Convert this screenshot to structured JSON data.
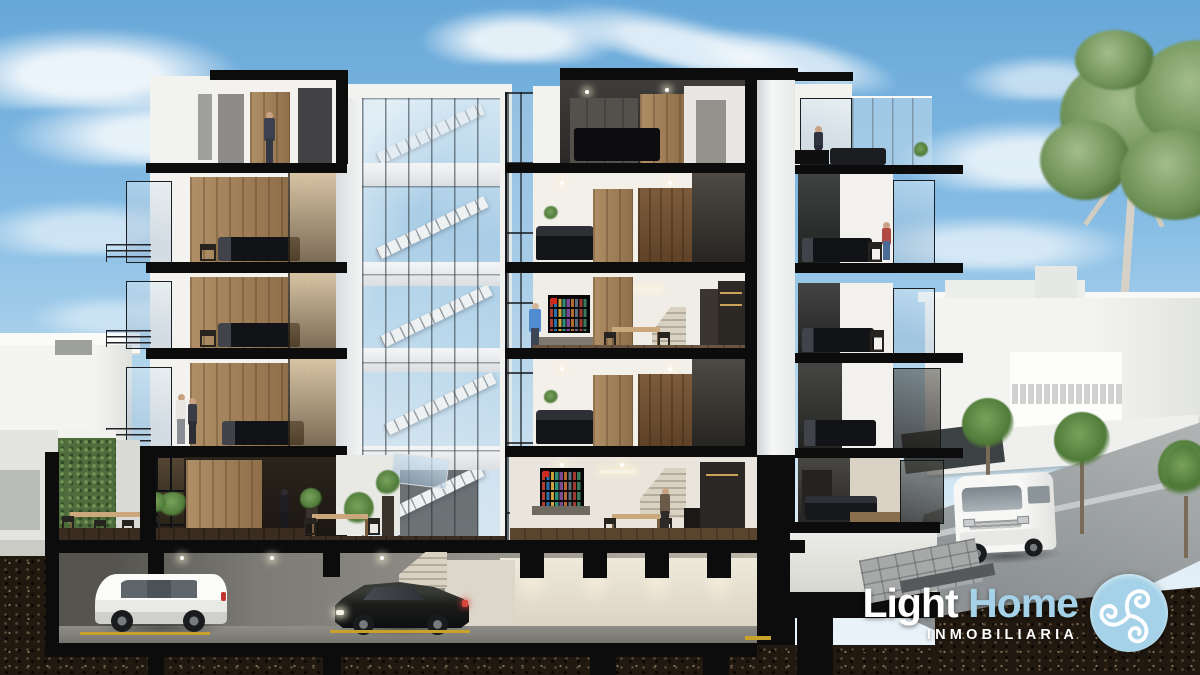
{
  "page": {
    "title": "Light Home Inmobiliaria"
  },
  "logo": {
    "brand_primary": "Light",
    "brand_secondary": "Home",
    "subtitle": "INMOBILIARIA",
    "badge_icon": "triskelion-icon",
    "colors": {
      "brand_white": "#ffffff",
      "brand_blue": "#a5d2e8",
      "badge_background": "#a5d2e8",
      "badge_glyph": "#ffffff"
    }
  },
  "scene": {
    "type": "architectural-cross-section-render",
    "subject": "Cut-away render of a five-level residential building with basement parking (white SUV and dark sedan), central glass stair atrium, furnished apartments with people, ground-floor terraces with dining tables and an ivy wall, neighboring white houses, a street with a white van and trees, under a blue sky with clouds",
    "palette": {
      "sky_top": "#67a7d8",
      "sky_horizon": "#dcecf6",
      "structure_black": "#0c0c0d",
      "wall_white": "#f2f2ef",
      "wood": "#a98a60",
      "tinted_glass": "#2e2a24",
      "atrium_glass": "#bcd9ec",
      "foliage": "#6e8f58",
      "soil": "#211910",
      "asphalt": "#9ea3a5",
      "concrete": "#85837d",
      "parking_line_yellow": "#c9a22a"
    }
  }
}
